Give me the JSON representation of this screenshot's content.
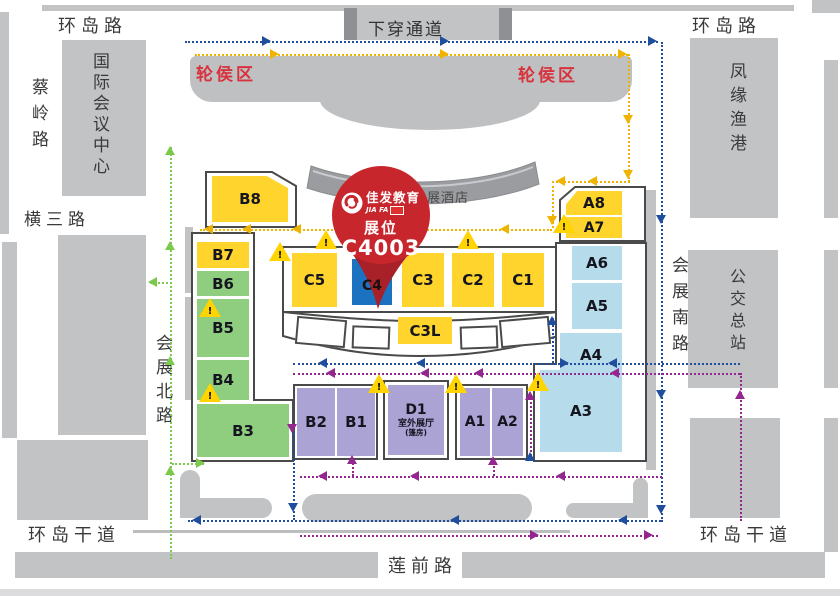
{
  "roads": {
    "ring_road_left": "环岛路",
    "ring_road_right": "环岛路",
    "underpass": "下穿通道",
    "cailing_road": "蔡岭路",
    "intl_conference_center": "国际会议中心",
    "hengsan_road": "横三路",
    "exhibition_north_road": "会展北路",
    "ring_trunk_west": "环岛干道",
    "lianqian_road": "莲前路",
    "ring_trunk_east": "环岛干道",
    "fengyuan_fishing_port": "凤缘渔港",
    "exhibition_south_road": "会展南路",
    "bus_terminal": "公交总站"
  },
  "areas": {
    "waiting_left": "轮侯区",
    "waiting_right": "轮侯区",
    "hotel": "会展酒店"
  },
  "pin": {
    "brand": "佳发教育",
    "brand_latin": "JIA FA",
    "label": "展位",
    "booth": "C4003"
  },
  "halls": {
    "b8": "B8",
    "b7": "B7",
    "b6": "B6",
    "b5": "B5",
    "b4": "B4",
    "b3": "B3",
    "c5": "C5",
    "c4": "C4",
    "c3": "C3",
    "c2": "C2",
    "c1": "C1",
    "c3l": "C3L",
    "a8": "A8",
    "a7": "A7",
    "a6": "A6",
    "a5": "A5",
    "a4": "A4",
    "a3": "A3",
    "b2": "B2",
    "b1": "B1",
    "a1": "A1",
    "a2": "A2",
    "d1": "D1",
    "d1_sub": "室外展厅",
    "d1_sub2": "(篷房)"
  },
  "icons": {
    "warning_glyph": "!"
  },
  "colors": {
    "hall_yellow": "#ffd42d",
    "hall_green": "#8fce7e",
    "hall_blue": "#b6dbeb",
    "hall_purple": "#aba3d4",
    "highlight_blue": "#1b72c0",
    "pin_red": "#c8262d",
    "building_gray": "#c2c3c5",
    "path_blue": "#1f4e9e",
    "path_yellow": "#f0b400",
    "path_green": "#7dc94e",
    "path_purple": "#93278f",
    "label_red": "#d8333c"
  }
}
